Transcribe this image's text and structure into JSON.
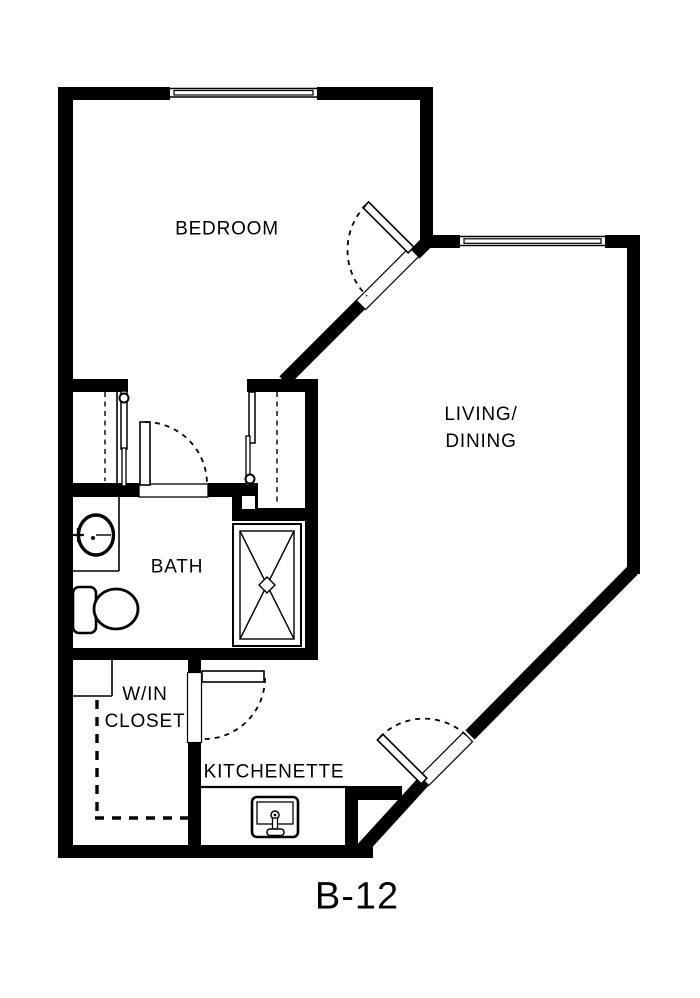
{
  "floor_plan": {
    "unit_label": "B-12",
    "rooms": {
      "bedroom": {
        "label": "BEDROOM"
      },
      "living_dining": {
        "label_line1": "LIVING/",
        "label_line2": "DINING"
      },
      "bath": {
        "label": "BATH"
      },
      "walk_in_closet": {
        "label_line1": "W/IN",
        "label_line2": "CLOSET"
      },
      "kitchenette": {
        "label": "KITCHENETTE"
      }
    },
    "fixtures": [
      "bathroom-sink",
      "toilet",
      "shower",
      "kitchen-sink"
    ],
    "doors": [
      "bedroom-door",
      "bath-door",
      "walk-in-closet-door",
      "kitchenette-door",
      "entry-door",
      "closet-sliding-doors"
    ],
    "windows": [
      "bedroom-window",
      "living-dining-window"
    ],
    "colors": {
      "wall": "#000000",
      "background": "#ffffff",
      "text": "#000000"
    }
  }
}
